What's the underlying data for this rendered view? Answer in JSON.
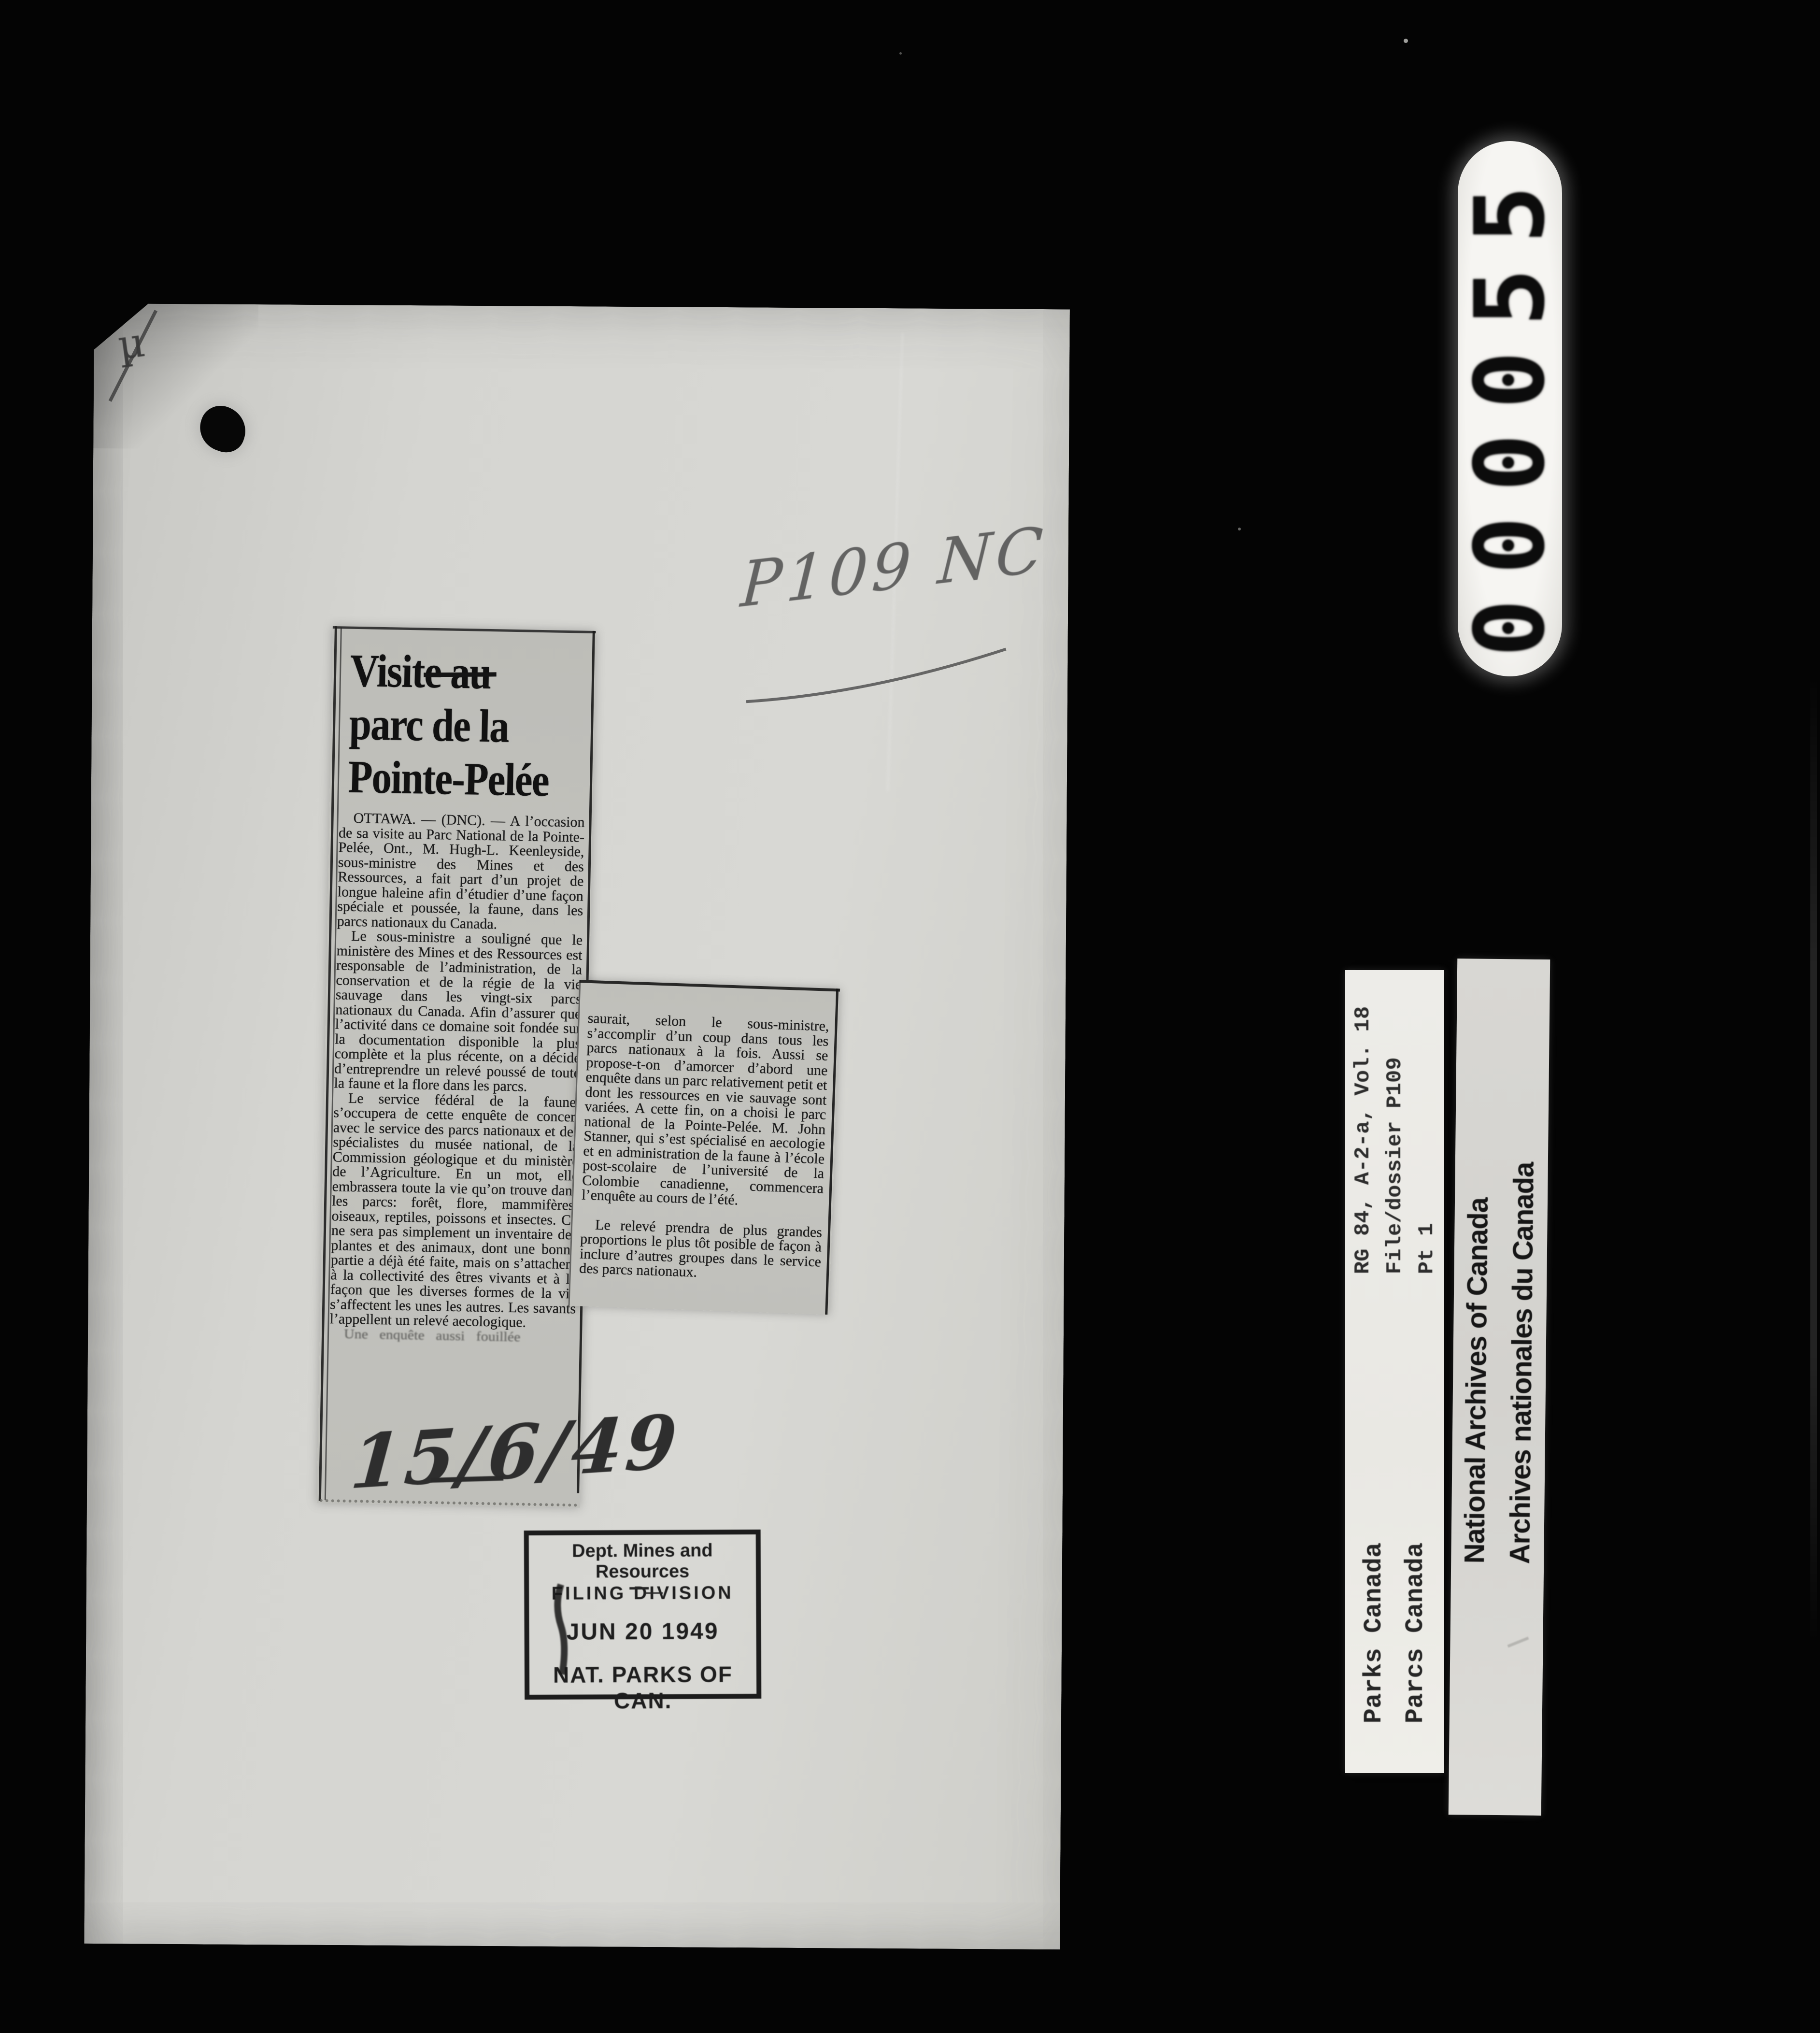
{
  "frame_counter": {
    "digits": "000055"
  },
  "clipping": {
    "headline": {
      "word1": "Visite",
      "word2_struck": "au",
      "line2": "parc de la",
      "line3": "Pointe-Pelée"
    },
    "col1_paragraphs": [
      "OTTAWA. — (DNC). — A l’occasion de sa visite au Parc National de la Pointe-Pelée, Ont., M. Hugh-L. Keenleyside, sous-ministre des Mines et des Ressources, a fait part d’un projet de longue haleine afin d’étudier d’une façon spéciale et poussée, la faune, dans les parcs nationaux du Canada.",
      "Le sous-ministre a souligné que le ministère des Mines et des Ressources est responsable de l’administration, de la conservation et de la régie de la vie sauvage dans les vingt-six parcs nationaux du Canada. Afin d’assurer que l’activité dans ce domaine soit fondée sur la documentation disponible la plus complète et la plus récente, on a décidé d’entreprendre un relevé poussé de toute la faune et la flore dans les parcs.",
      "Le service fédéral de la faune, s’occupera de cette enquête de concert avec le service des parcs nationaux et des spécialistes du musée national, de la Commission géologique et du ministère de l’Agriculture. En un mot, elle embrassera toute la vie qu’on trouve dans les parcs: forêt, flore, mammifères, oiseaux, reptiles, poissons et insectes. Ce ne sera pas simplement un inventaire des plantes et des animaux, dont une bonne partie a déjà été faite, mais on s’attachera à la collectivité des êtres vivants et à la façon que les diverses formes de la vie s’affectent les unes les autres. Les savants l’appellent un relevé aecologique."
    ],
    "col1_cutoff_line": "Une enquête aussi fouillée",
    "col2_paragraphs": [
      "saurait, selon le sous-ministre, s’accomplir d’un coup dans tous les parcs nationaux à la fois. Aussi se propose-t-on d’amorcer d’abord une enquête dans un parc relativement petit et dont les ressources en vie sauvage sont variées. A cette fin, on a choisi le parc national de la Pointe-Pelée. M. John Stanner, qui s’est spécialisé en aecologie et en administration de la faune à l’école post-scolaire de l’université de la Colombie canadienne, commencera l’enquête au cours de l’été.",
      "Le relevé prendra de plus grandes proportions le plus tôt posible de façon à inclure d’autres groupes dans le service des parcs nationaux."
    ]
  },
  "handwriting": {
    "file_code": "P109 NC",
    "date": "15/6/49",
    "corner_mark": "µ"
  },
  "stamp": {
    "line1": "Dept. Mines and Resources",
    "line2": "FILING DIVISION",
    "date": "JUN 20 1949",
    "line4": "NAT. PARKS OF CAN."
  },
  "labels": {
    "archival_reference": [
      "RG 84, A-2-a, Vol. 18",
      "File/dossier P109",
      "Pt 1"
    ],
    "parks": [
      "Parks Canada",
      "Parcs Canada"
    ],
    "nac": [
      "National Archives of Canada",
      "Archives nationales du Canada"
    ]
  },
  "colors": {
    "background": "#040404",
    "page": "#d5d5d1",
    "newsprint": "#c1c1bc",
    "ink": "#1b1b1b",
    "pencil": "#4f4f4f",
    "strip_white": "#edece8",
    "counter_white": "#f6f5f2"
  }
}
